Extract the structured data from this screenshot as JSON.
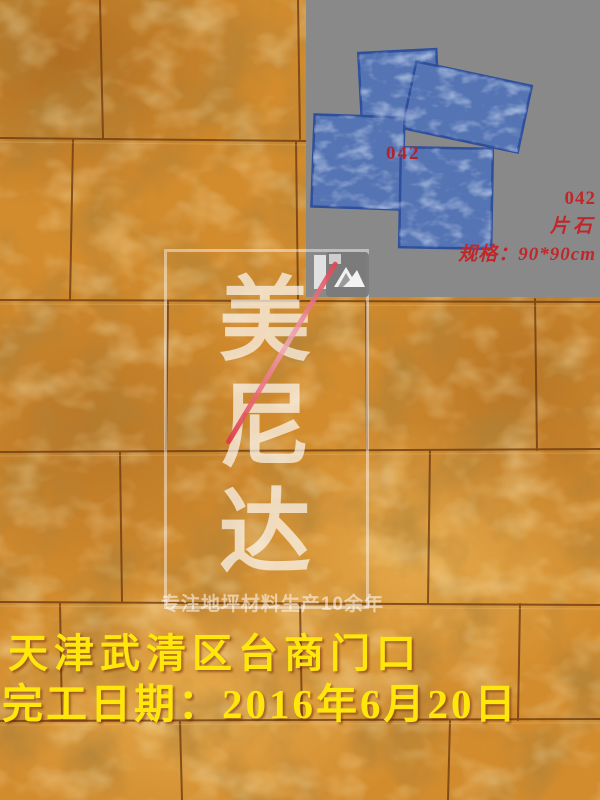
{
  "product_panel": {
    "mold_code_overlay": "042"
  },
  "product_info": {
    "code": "042",
    "type": "片石",
    "spec": "规格：90*90cm"
  },
  "watermark": {
    "brand_chars": [
      "美",
      "尼",
      "达"
    ],
    "tagline": "专注地坪材料生产10余年",
    "logo": "mountain-icon"
  },
  "caption": {
    "line1": "天津武清区台商门口",
    "line2": "完工日期：2016年6月20日"
  },
  "colors": {
    "caption_yellow": "#ffe70c",
    "label_red": "#c1262b",
    "mold_blue": "#5574b4",
    "panel_gray": "#898989",
    "floor_amber": "#d28c2e"
  }
}
